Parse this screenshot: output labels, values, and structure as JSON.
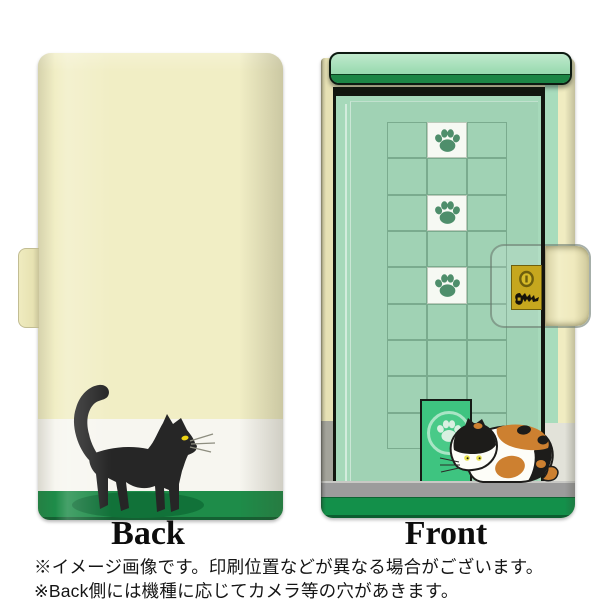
{
  "product_preview": {
    "type": "flip-phone-case-mockup",
    "back_panel": {
      "label": "Back",
      "illustration": "black-cat-walking",
      "design_bands": [
        "cream",
        "white",
        "green"
      ]
    },
    "front_panel": {
      "label": "Front",
      "illustration": "green-door-with-paw-windows-and-calico-cat",
      "grid": {
        "cols": 3,
        "rows": 9,
        "paw_tile_col": 1,
        "paw_tile_rows": [
          0,
          2,
          4
        ]
      },
      "has_cat_door_paw": true,
      "has_lock_plate": true
    },
    "footnotes": {
      "line1": "※イメージ画像です。印刷位置などが異なる場合がございます。",
      "line2": "※Back側には機種に応じてカメラ等の穴があきます。"
    },
    "icons": {
      "paw_tile": "paw-print-icon",
      "cat_door": "paw-print-icon",
      "lock": "keyhole-icon",
      "key": "key-icon"
    },
    "colors": {
      "back_cream": "#f1eec5",
      "band_white": "#f7f6f0",
      "band_green": "#1e8c49",
      "door_mint": "#a6d9ba",
      "top_bar_mint": "#9fdcb4",
      "top_bar_green": "#1c8545",
      "cat_door_green": "#3ec480",
      "paw_green": "#4e8e6b",
      "floor_gray": "#9c9c9c",
      "bottom_green": "#13904a",
      "lock_gold": "#c6a71e",
      "calico_orange": "#cd8030",
      "cat_black": "#262626",
      "eye_yellow": "#edd313"
    }
  }
}
